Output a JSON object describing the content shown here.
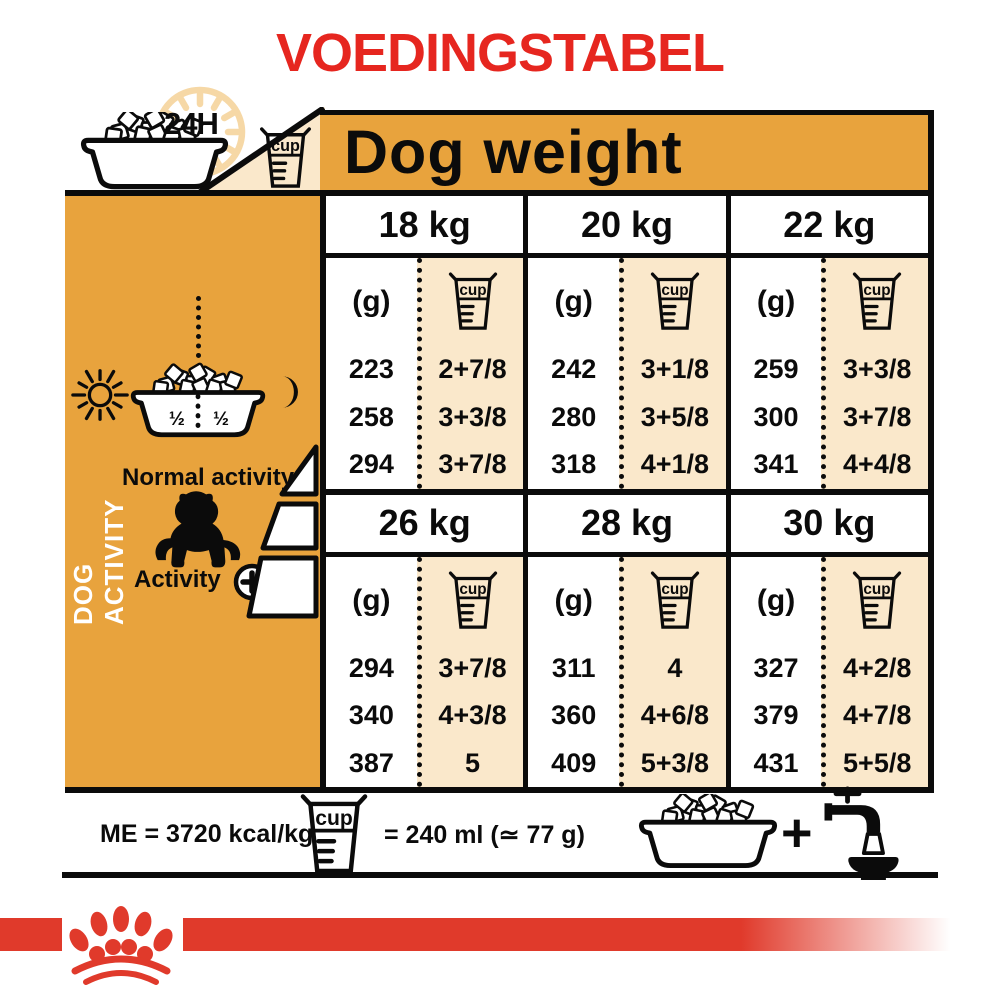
{
  "title": "VOEDINGSTABEL",
  "colors": {
    "orange": "#E8A33D",
    "cream": "#FAE8CB",
    "red_title": "#E6261F",
    "red_logo": "#E03A2B",
    "clock": "#F6D8A6",
    "black": "#0B0B0B"
  },
  "top": {
    "hours_label": "24H",
    "dog_weight_label": "Dog weight",
    "cup_text": "cup"
  },
  "sidebar": {
    "vertical_label": "DOG ACTIVITY",
    "bowl_half_left": "½",
    "bowl_half_right": "½",
    "normal_activity_label": "Normal activity",
    "activity_label": "Activity",
    "activity_plus": "+"
  },
  "table": {
    "grams_header": "(g)",
    "cup_text": "cup",
    "blocks": [
      {
        "columns": [
          {
            "weight": "18 kg",
            "rows": [
              {
                "g": "223",
                "cup": "2+7/8"
              },
              {
                "g": "258",
                "cup": "3+3/8"
              },
              {
                "g": "294",
                "cup": "3+7/8"
              }
            ]
          },
          {
            "weight": "20 kg",
            "rows": [
              {
                "g": "242",
                "cup": "3+1/8"
              },
              {
                "g": "280",
                "cup": "3+5/8"
              },
              {
                "g": "318",
                "cup": "4+1/8"
              }
            ]
          },
          {
            "weight": "22 kg",
            "rows": [
              {
                "g": "259",
                "cup": "3+3/8"
              },
              {
                "g": "300",
                "cup": "3+7/8"
              },
              {
                "g": "341",
                "cup": "4+4/8"
              }
            ]
          }
        ]
      },
      {
        "columns": [
          {
            "weight": "26 kg",
            "rows": [
              {
                "g": "294",
                "cup": "3+7/8"
              },
              {
                "g": "340",
                "cup": "4+3/8"
              },
              {
                "g": "387",
                "cup": "5"
              }
            ]
          },
          {
            "weight": "28 kg",
            "rows": [
              {
                "g": "311",
                "cup": "4"
              },
              {
                "g": "360",
                "cup": "4+6/8"
              },
              {
                "g": "409",
                "cup": "5+3/8"
              }
            ]
          },
          {
            "weight": "30 kg",
            "rows": [
              {
                "g": "327",
                "cup": "4+2/8"
              },
              {
                "g": "379",
                "cup": "4+7/8"
              },
              {
                "g": "431",
                "cup": "5+5/8"
              }
            ]
          }
        ]
      }
    ]
  },
  "footer": {
    "energy_label": "ME = 3720 kcal/kg",
    "cup_text": "cup",
    "cup_equivalence": "= 240 ml (≃ 77 g)",
    "plus_sign": "+"
  }
}
